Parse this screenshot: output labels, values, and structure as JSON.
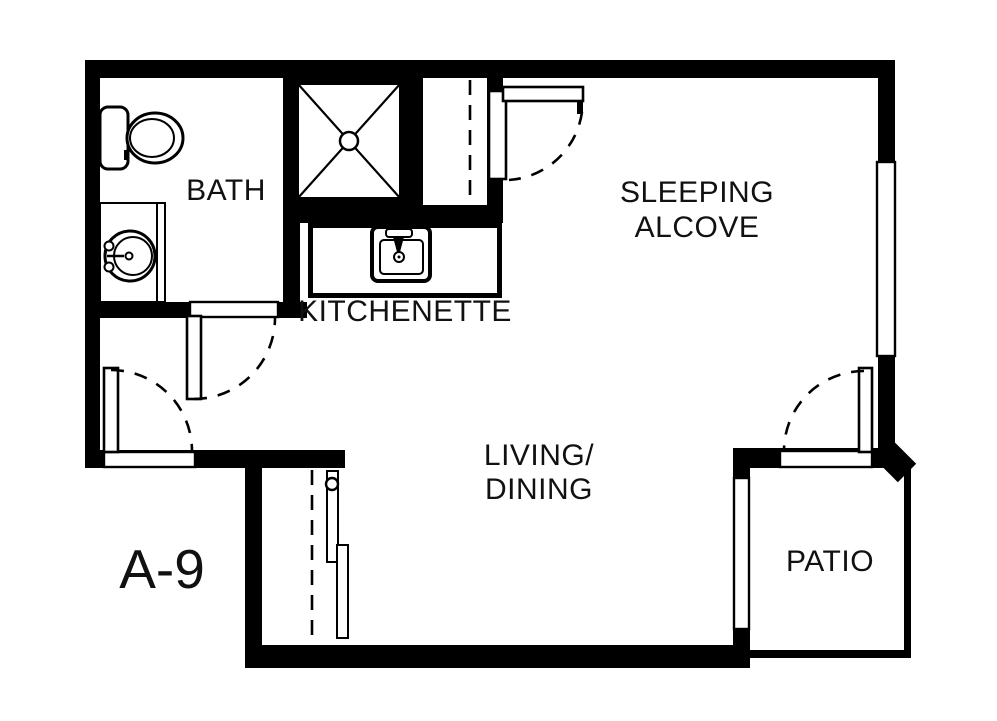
{
  "unit": {
    "label": "A-9"
  },
  "rooms": {
    "bath": "BATH",
    "kitchenette": "KITCHENETTE",
    "sleeping_alcove_line1": "SLEEPING",
    "sleeping_alcove_line2": "ALCOVE",
    "living_dining_line1": "LIVING/",
    "living_dining_line2": "DINING",
    "patio": "PATIO"
  },
  "elements": {
    "doors": [
      "entry-door",
      "bath-door",
      "closet-door",
      "patio-door"
    ],
    "windows": [
      "right-wall-window",
      "patio-window"
    ],
    "closets": [
      "entry-closet",
      "wardrobe-closet"
    ],
    "fixtures": [
      "toilet",
      "bathroom-sink",
      "shower",
      "kitchen-counter",
      "kitchen-sink"
    ]
  },
  "colors": {
    "line": "#000000",
    "background": "#ffffff",
    "text": "#111111"
  }
}
